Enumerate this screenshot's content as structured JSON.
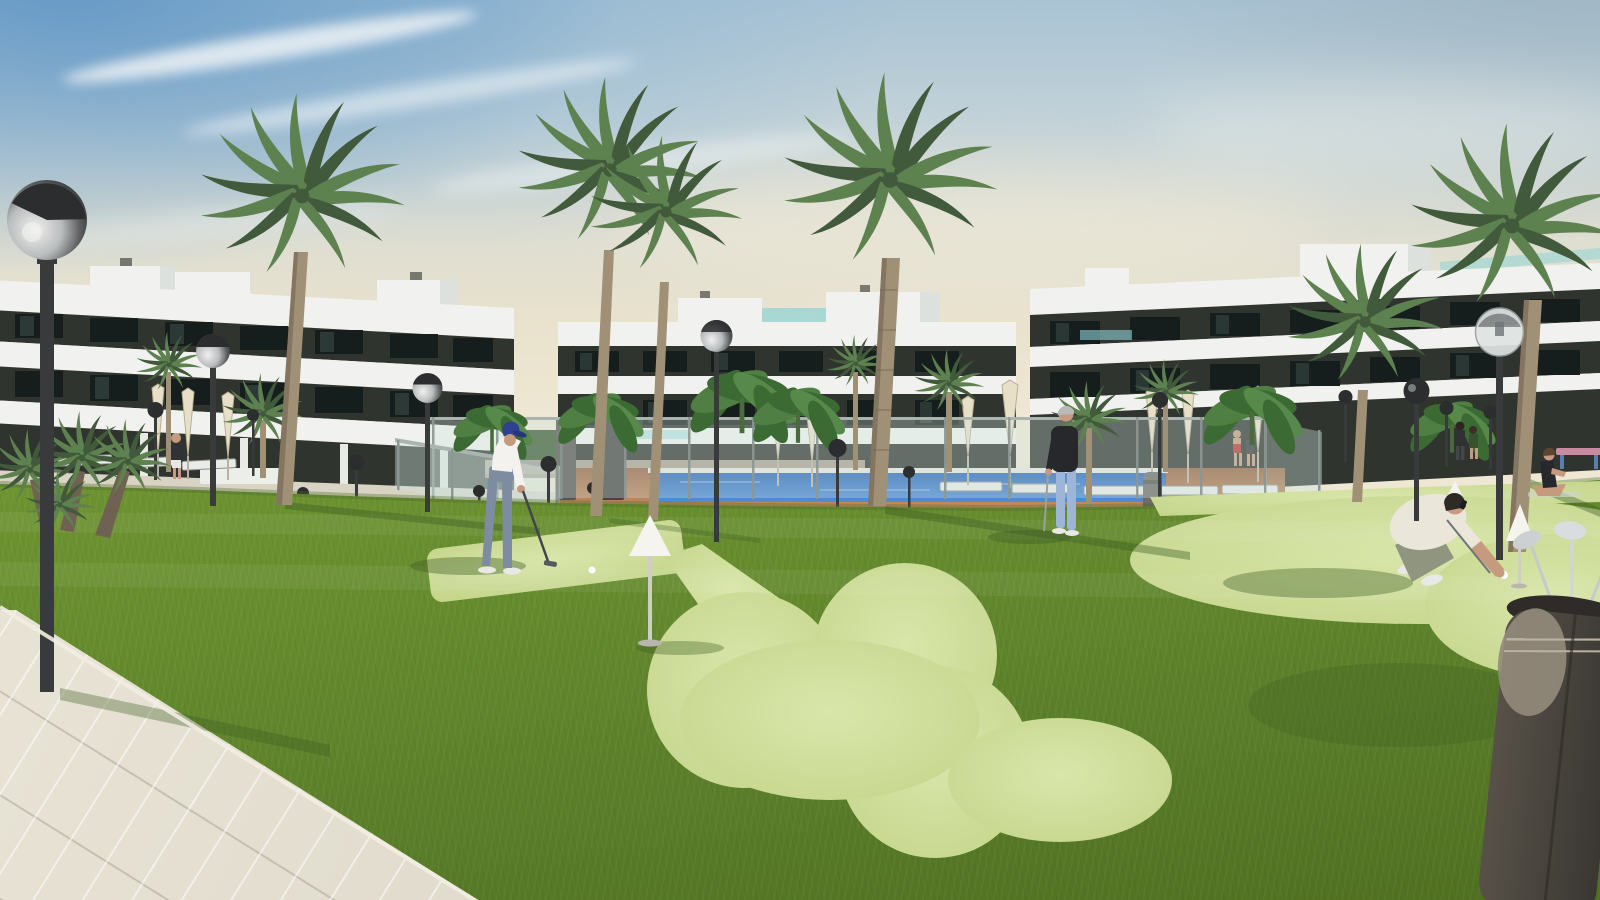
{
  "scene": {
    "description": "3D architectural rendering of a modern white apartment complex with palm trees, a swimming pool and a mini putting green at golden hour",
    "objects": [
      "apartment-building-left",
      "apartment-building-center",
      "apartment-building-right",
      "tall-fan-palms",
      "globe-street-lamps",
      "swimming-pool",
      "glass-pool-fence",
      "terracotta-pool-deck",
      "closed-umbrellas",
      "sun-loungers",
      "putting-green",
      "white-cone-hole-markers",
      "golf-balls",
      "golfer-putting",
      "man-leaning-on-putter",
      "man-crouching-placing-ball",
      "woman-doing-yoga",
      "people-by-pool",
      "golf-bag-with-clubs",
      "tiled-walkway",
      "palm-bushes",
      "banana-plants"
    ]
  },
  "colors": {
    "sky_haze": "#e9e2cd",
    "cloud": "#f4f7f8",
    "bld_white": "#f1f2ef",
    "bld_white_shade": "#dde1de",
    "bld_dark": "#30342f",
    "bld_window": "#1d2724",
    "bld_glass": "#8fd4d6",
    "palm_leaf": "#5e8150",
    "palm_leaf_dark": "#415a3b",
    "palm_trunk": "#a09176",
    "palm_trunk_dark": "#6f6252",
    "lamp_post": "#393a3b",
    "lamp_glass": "#dfe3e2",
    "lamp_dark": "#2b2d2e",
    "pool_water": "#2f72c0",
    "pool_deck": "#bb8156",
    "fence_glass": "#cfe4dd",
    "stone_wall": "#ab9f8d",
    "umbrella": "#e7dfc8",
    "grass": "#79a037",
    "grass_dark": "#587c29",
    "lime_green": "#cbdc93",
    "shadow_green": "#3c5c22",
    "pavement": "#ded9cb",
    "pavement_lit": "#ebe6d8",
    "skin": "#c69a7e",
    "shirt_white": "#f3f2ee",
    "cap_blue": "#2e4193",
    "pants_grey": "#7e8ca2",
    "jeans_blue": "#9db5d6",
    "dark_clothing": "#26282b",
    "cream_shirt": "#eae6da",
    "red_swimsuit": "#b2392e",
    "bag_dark": "#46413c",
    "bag_panel": "#948b7b",
    "club_silver": "#ccd0d3",
    "cone_white": "#f6f4ee"
  }
}
